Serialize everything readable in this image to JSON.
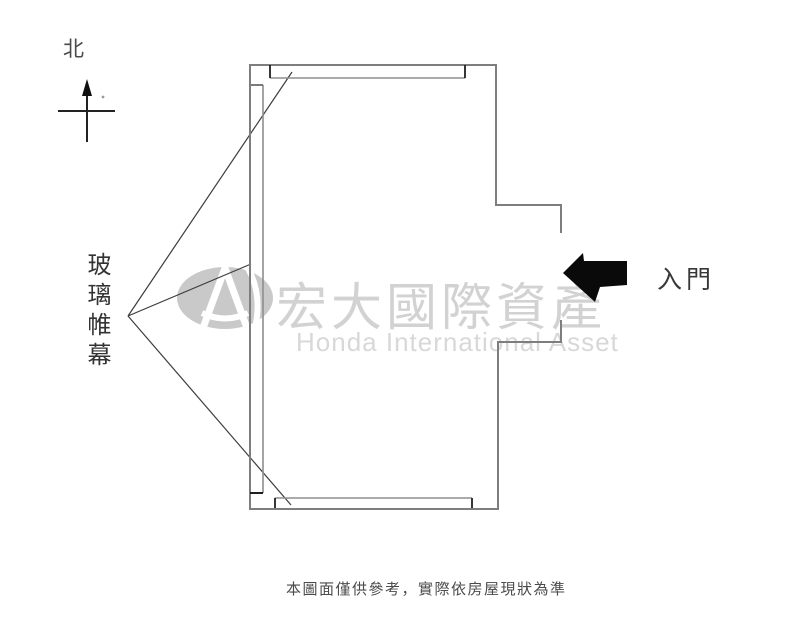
{
  "compass": {
    "north_label": "北"
  },
  "plan": {
    "glass_curtain_label": "玻璃帷幕",
    "entry_label": "入門"
  },
  "watermark": {
    "title_cn": "宏大國際資產",
    "subtitle_en": "Honda International Asset"
  },
  "footer": {
    "caption": "本圖面僅供參考，實際依房屋現狀為準"
  },
  "colors": {
    "wall": "#7e7e7e",
    "glass_line": "#8e8e8e",
    "tick": "#1f1f1f",
    "leader": "#3c3c3c",
    "entry_arrow": "#0a0a0a",
    "watermark_gray": "#d2d2d2",
    "logo_gray": "#c9c9c9",
    "caption_text": "#4b4b4b"
  }
}
